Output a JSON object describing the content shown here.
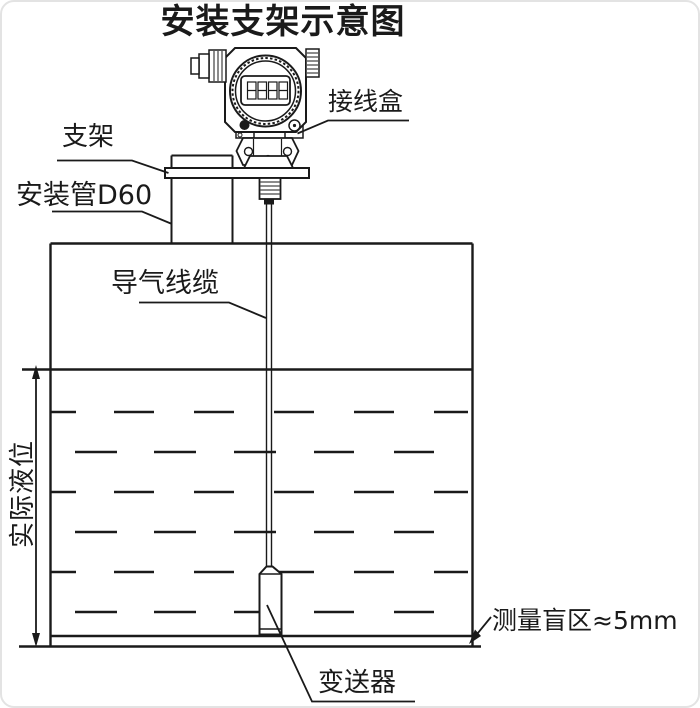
{
  "title": "安装支架示意图",
  "labels": {
    "junction_box": "接线盒",
    "bracket": "支架",
    "mounting_pipe": "安装管D60",
    "vent_cable": "导气线缆",
    "actual_level": "实际液位",
    "blind_zone": "测量盲区≈5mm",
    "transmitter": "变送器"
  },
  "colors": {
    "line": "#1a1a1a",
    "background": "#ffffff"
  }
}
